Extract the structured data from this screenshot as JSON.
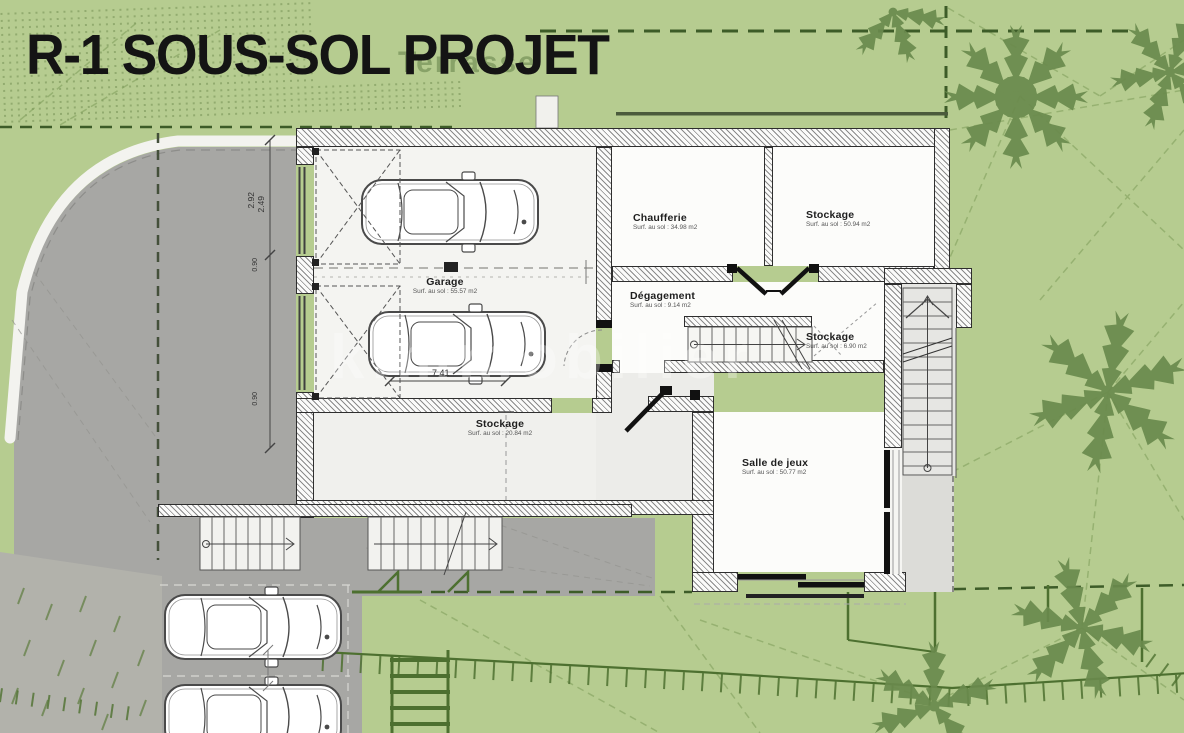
{
  "title": "R-1 SOUS-SOL PROJET",
  "ghost_label": "Terrasse",
  "watermark": "kimmobilier",
  "rooms": {
    "garage": {
      "name": "Garage",
      "area": "Surf. au sol : 55.57 m2"
    },
    "chaufferie": {
      "name": "Chaufferie",
      "area": "Surf. au sol : 34.98 m2"
    },
    "stockage_haut": {
      "name": "Stockage",
      "area": "Surf. au sol : 50.94 m2"
    },
    "degagement": {
      "name": "Dégagement",
      "area": "Surf. au sol : 9.14 m2"
    },
    "stockage_milieu": {
      "name": "Stockage",
      "area": "Surf. au sol : 6.90 m2"
    },
    "stockage_bas": {
      "name": "Stockage",
      "area": "Surf. au sol : 20.84 m2"
    },
    "salle_de_jeux": {
      "name": "Salle de jeux",
      "area": "Surf. au sol : 50.77 m2"
    }
  },
  "dimensions": {
    "garage_largeur": "7.41",
    "dim_a": "2.92",
    "dim_b": "2.49",
    "dim_c": "0.90",
    "dim_d": "0.90"
  },
  "colors": {
    "garden_green": "#b6cc90",
    "tree_green": "#6a8a4d",
    "driveway_gray": "#a7a7a4",
    "boundary_green": "#3d5c28",
    "wall_dark": "#2e2e2e"
  }
}
